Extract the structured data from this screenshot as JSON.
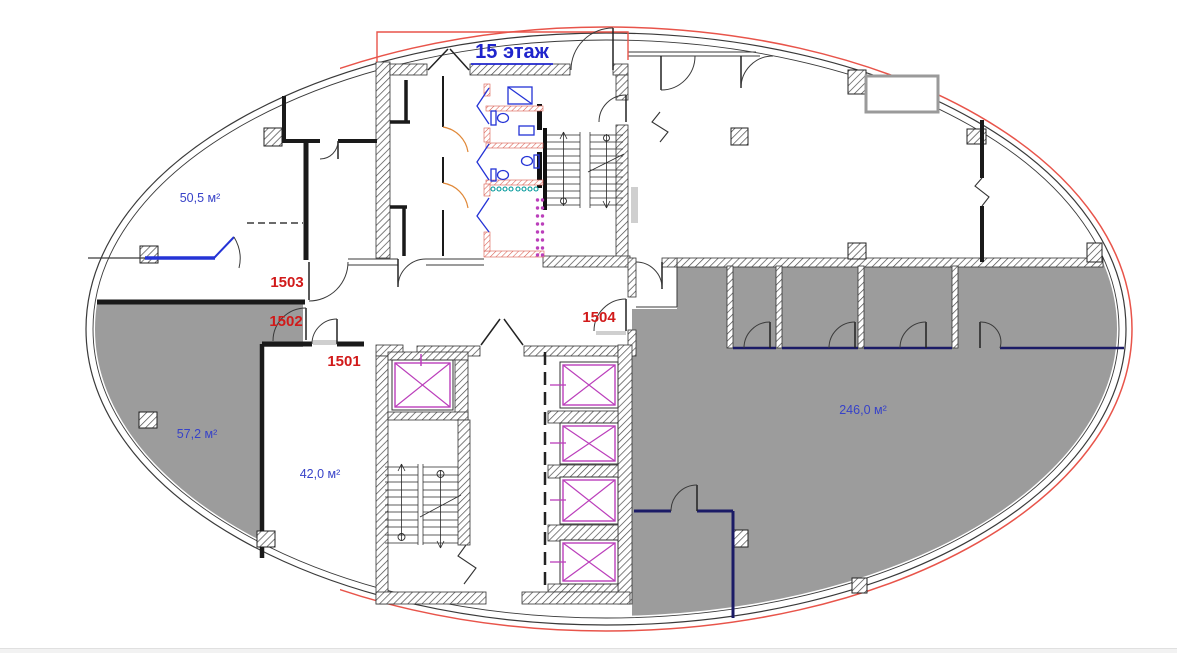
{
  "title": {
    "text": "15 этаж"
  },
  "areas": [
    {
      "room": "top-left",
      "text": "50,5 м²"
    },
    {
      "room": "left",
      "text": "57,2 м²"
    },
    {
      "room": "bottom-center-left",
      "text": "42,0 м²"
    },
    {
      "room": "right",
      "text": "246,0 м²"
    }
  ],
  "units": [
    {
      "number": "1501"
    },
    {
      "number": "1502"
    },
    {
      "number": "1503"
    },
    {
      "number": "1504"
    }
  ],
  "colors": {
    "title-blue": "#1f24cc",
    "area-blue": "#3742c8",
    "area-navy": "#2b2b86",
    "unit-red": "#d11a1a",
    "accent-red": "#e8544a",
    "magenta": "#bb3fbb",
    "room-gray": "#9c9c9c",
    "navy-wall": "#1b1b66",
    "fixture-blue": "#2433d6",
    "teal": "#00989a",
    "door-orange": "#e08838",
    "wall-dark": "#1a1a1a",
    "line-dark": "#3a3a3a"
  }
}
